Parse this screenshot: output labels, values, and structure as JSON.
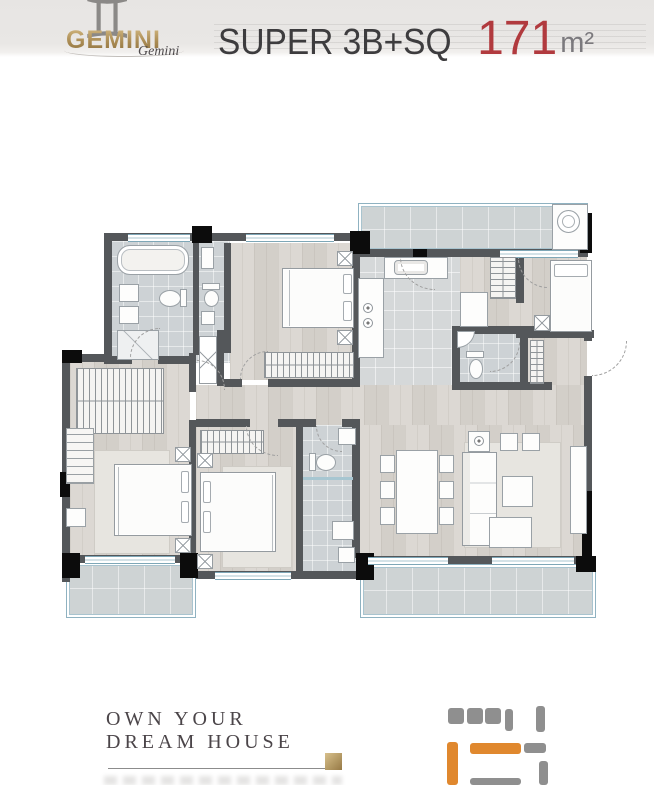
{
  "header": {
    "logo": {
      "zodiac_symbol": "♊",
      "brand": "GEMINI",
      "brand_script": "Gemini"
    },
    "title": {
      "label": "SUPER 3B+SQ",
      "area_value": "171",
      "area_unit": "m²"
    }
  },
  "footer": {
    "tagline_line_1": "OWN YOUR",
    "tagline_line_2": "DREAM HOUSE"
  },
  "colors": {
    "accent_red": "#b13a3e",
    "brand_gold": "#a98a52",
    "wall_gray": "#54575a",
    "window_blue": "#7ea7b7",
    "wood_floor": "#d8d4ce",
    "tile_floor": "#cdd2d5",
    "minimap_orange": "#e0882e",
    "minimap_gray": "#8f8f8f"
  }
}
